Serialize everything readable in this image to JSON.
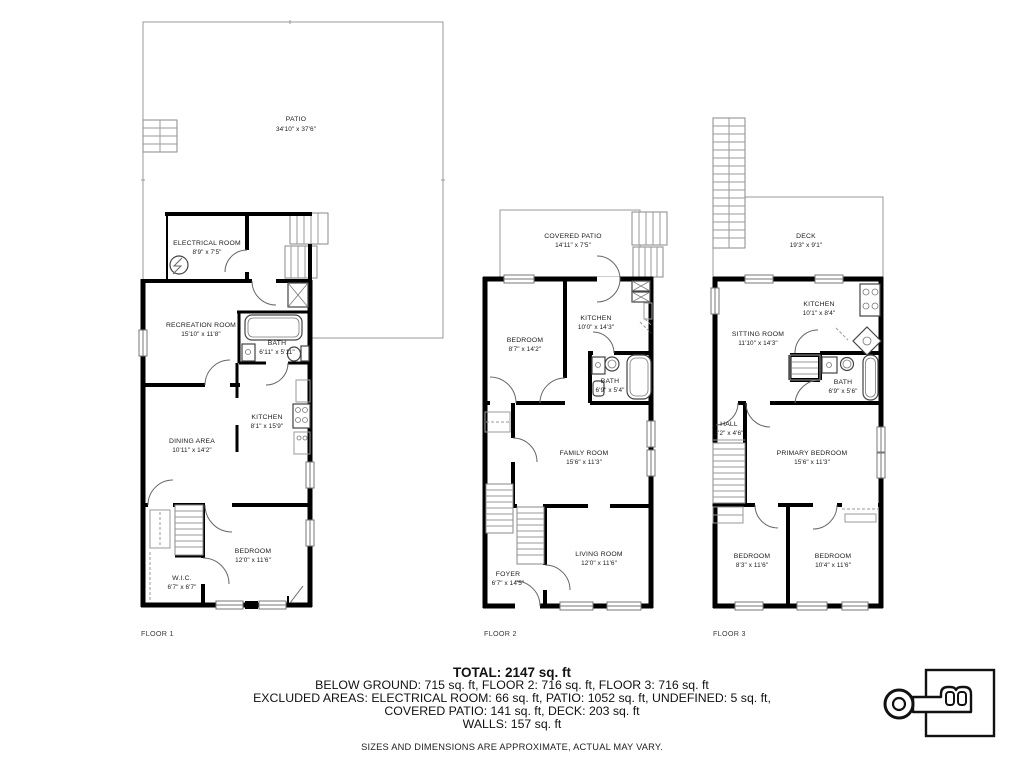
{
  "colors": {
    "walls": "#000000",
    "background": "#ffffff",
    "thin_lines": "#8a8a8a"
  },
  "floors": [
    {
      "label": "FLOOR 1",
      "rooms": [
        {
          "name": "PATIO",
          "dims": "34'10\" x 37'6\""
        },
        {
          "name": "ELECTRICAL ROOM",
          "dims": "8'9\" x 7'5\""
        },
        {
          "name": "RECREATION ROOM",
          "dims": "15'10\" x 11'8\""
        },
        {
          "name": "BATH",
          "dims": "6'11\" x 5'11\""
        },
        {
          "name": "KITCHEN",
          "dims": "8'1\" x 15'9\""
        },
        {
          "name": "DINING AREA",
          "dims": "10'11\" x 14'2\""
        },
        {
          "name": "BEDROOM",
          "dims": "12'0\" x 11'6\""
        },
        {
          "name": "W.I.C.",
          "dims": "6'7\" x 6'7\""
        }
      ]
    },
    {
      "label": "FLOOR 2",
      "rooms": [
        {
          "name": "COVERED PATIO",
          "dims": "14'11\" x 7'5\""
        },
        {
          "name": "BEDROOM",
          "dims": "8'7\" x 14'2\""
        },
        {
          "name": "KITCHEN",
          "dims": "10'0\" x 14'3\""
        },
        {
          "name": "BATH",
          "dims": "6'9\" x 5'4\""
        },
        {
          "name": "FAMILY ROOM",
          "dims": "15'6\" x 11'3\""
        },
        {
          "name": "LIVING ROOM",
          "dims": "12'0\" x 11'6\""
        },
        {
          "name": "FOYER",
          "dims": "6'7\" x 14'5\""
        }
      ]
    },
    {
      "label": "FLOOR 3",
      "rooms": [
        {
          "name": "DECK",
          "dims": "19'3\" x 9'1\""
        },
        {
          "name": "SITTING ROOM",
          "dims": "11'10\" x 14'3\""
        },
        {
          "name": "KITCHEN",
          "dims": "10'1\" x 8'4\""
        },
        {
          "name": "BATH",
          "dims": "6'9\" x 5'6\""
        },
        {
          "name": "HALL",
          "dims": "3'2\" x 4'6\""
        },
        {
          "name": "PRIMARY BEDROOM",
          "dims": "15'6\" x 11'3\""
        },
        {
          "name": "BEDROOM",
          "dims": "8'3\" x 11'6\""
        },
        {
          "name": "BEDROOM",
          "dims": "10'4\" x 11'6\""
        }
      ]
    }
  ],
  "summary": {
    "total": "TOTAL: 2147 sq. ft",
    "line1": "BELOW GROUND: 715 sq. ft, FLOOR 2: 716 sq. ft, FLOOR 3: 716 sq. ft",
    "line2": "EXCLUDED AREAS: ELECTRICAL ROOM: 66 sq. ft, PATIO: 1052 sq. ft, UNDEFINED: 5 sq. ft,",
    "line3": "COVERED PATIO: 141 sq. ft, DECK: 203 sq. ft",
    "line4": "WALLS: 157 sq. ft",
    "disclaimer": "SIZES AND DIMENSIONS ARE APPROXIMATE, ACTUAL MAY VARY."
  }
}
